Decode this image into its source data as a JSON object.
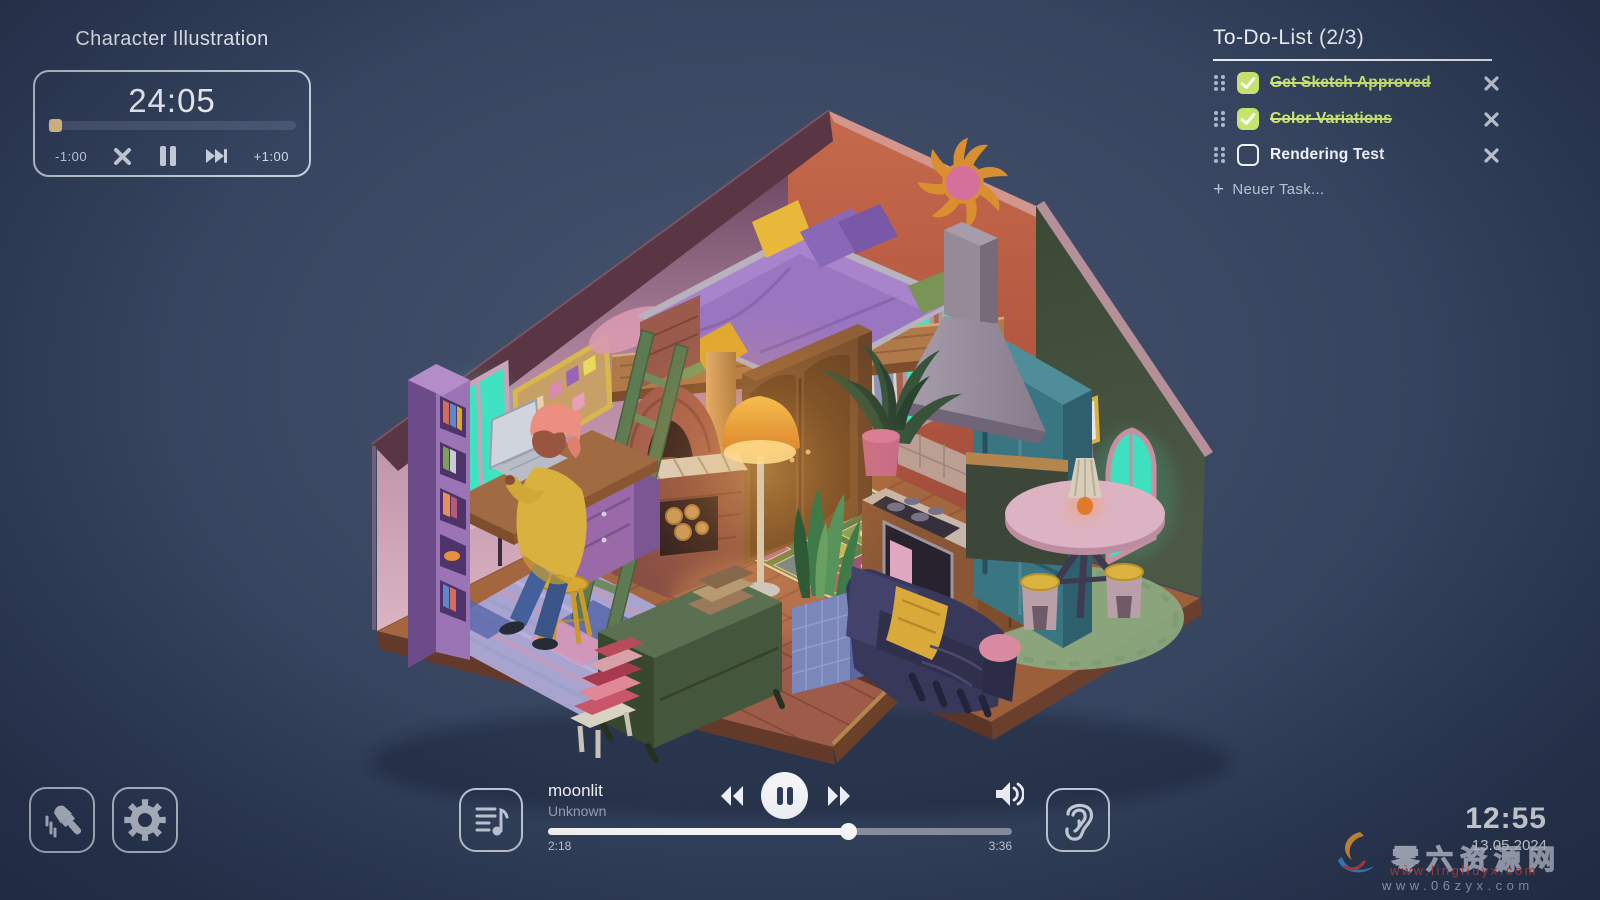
{
  "focus_timer": {
    "title": "Character Illustration",
    "time": "24:05",
    "progress_pct": 3,
    "minus_label": "-1:00",
    "plus_label": "+1:00",
    "icons": [
      "cancel-icon",
      "pause-icon",
      "skip-forward-icon"
    ]
  },
  "todo": {
    "title": "To-Do-List",
    "count": "(2/3)",
    "items": [
      {
        "label": "Get Sketch Approved",
        "done": true
      },
      {
        "label": "Color Variations",
        "done": true
      },
      {
        "label": "Rendering Test",
        "done": false
      }
    ],
    "add_label": "Neuer Task...",
    "accent_green": "#c6e36e"
  },
  "player": {
    "title": "moonlit",
    "artist": "Unknown",
    "elapsed": "2:18",
    "total": "3:36",
    "progress_pct": 64.6,
    "icons": [
      "playlist-icon",
      "rewind-icon",
      "pause-icon",
      "fast-forward-icon",
      "volume-icon"
    ]
  },
  "corner_buttons": {
    "icons": [
      "paintbrush-icon",
      "gear-icon",
      "ear-icon"
    ]
  },
  "clock": {
    "time": "12:55",
    "date": "13.05.2024"
  },
  "watermark": {
    "text_cn": "零六资源网",
    "url_red": "www.lingliuyx.com",
    "url_gray": "www.06zyx.com"
  },
  "illustration": {
    "kind": "isometric cozy room, night, lamp-lit",
    "items": [
      "loft bed with purple bedding",
      "green ladder",
      "brick pizza oven",
      "wooden wardrobe",
      "desk with laptop and seated character",
      "purple bookshelf",
      "teal windows",
      "bulletin board",
      "sun wall art",
      "range hood",
      "gas stove",
      "teal fridge",
      "palm plant",
      "glowing floor lamp",
      "granny-square rug",
      "snake plant in tiled planter",
      "striped area rug",
      "green dresser with books",
      "stack of books on stool",
      "dark couch with yellow blanket",
      "round pink table with lamp",
      "yellow stools",
      "round green rug",
      "arched window"
    ]
  },
  "colors": {
    "background": "#34425f",
    "panel_border": "#dde3f0",
    "text_primary": "#eef1f7",
    "text_muted": "#a9b2c4",
    "timer_knob": "#ecc58b",
    "wall_red": "#c2664a",
    "wall_pink": "#d9b6c2",
    "wall_green": "#46523f",
    "window_teal": "#3fe3c2"
  }
}
